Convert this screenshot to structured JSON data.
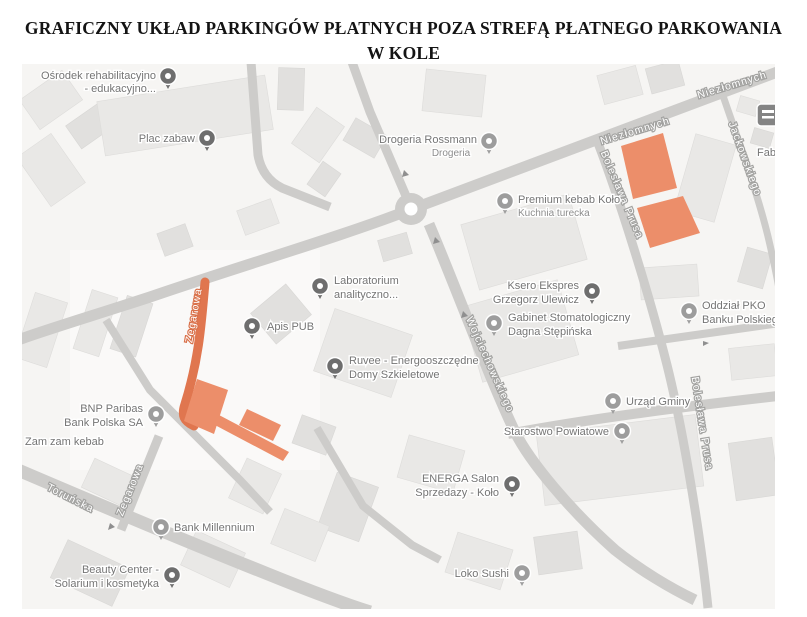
{
  "title": {
    "line1": "GRAFICZNY UKŁAD PARKINGÓW PŁATNYCH POZA STREFĄ PŁATNEGO PARKOWANIA",
    "line2": "W KOLE"
  },
  "map": {
    "colors": {
      "background": "#f6f5f3",
      "building": "#e9e8e6",
      "building_dark": "#e1e0de",
      "road": "#cdccca",
      "road_highlight": "#e0764f",
      "parking": "#ec8e6a",
      "pin_dark": "#6e6e6e",
      "pin_light": "#9d9d9d",
      "poi_text": "#757575",
      "street_halo": "#a2a2a0",
      "street_halo_orange": "#d9714a",
      "title_text": "#141414"
    },
    "pois": [
      {
        "line1": "Ośrodek rehabilitacyjno",
        "line2": "- edukacyjno...",
        "icon": "school-pin",
        "pin": "dark"
      },
      {
        "line1": "Plac zabaw",
        "line2": "",
        "icon": "playground-pin",
        "pin": "dark"
      },
      {
        "line1": "Drogeria Rossmann",
        "line2": "Drogeria",
        "icon": "store-pin",
        "pin": "light"
      },
      {
        "line1": "Premium kebab Koło",
        "line2": "Kuchnia turecka",
        "icon": "restaurant-pin",
        "pin": "light"
      },
      {
        "line1": "Laboratorium",
        "line2": "analityczno...",
        "icon": "lab-pin",
        "pin": "dark"
      },
      {
        "line1": "Apis PUB",
        "line2": "",
        "icon": "bar-pin",
        "pin": "dark"
      },
      {
        "line1": "Ksero Ekspres",
        "line2": "Grzegorz Ulewicz",
        "icon": "print-pin",
        "pin": "dark"
      },
      {
        "line1": "Gabinet Stomatologiczny",
        "line2": "Dagna Stępińska",
        "icon": "dentist-pin",
        "pin": "light"
      },
      {
        "line1": "Oddział PKO",
        "line2": "Banku Polskiego",
        "icon": "bank-pin",
        "pin": "light"
      },
      {
        "line1": "Ruvee - Energooszczędne",
        "line2": "Domy Szkieletowe",
        "icon": "home-pin",
        "pin": "dark"
      },
      {
        "line1": "Urząd Gminy",
        "line2": "",
        "icon": "government-pin",
        "pin": "light"
      },
      {
        "line1": "Starostwo Powiatowe",
        "line2": "",
        "icon": "government-pin",
        "pin": "light"
      },
      {
        "line1": "BNP Paribas",
        "line2": "Bank Polska SA",
        "icon": "bank-pin",
        "pin": "light"
      },
      {
        "line1": "Zam zam kebab",
        "line2": "",
        "icon": "none",
        "pin": "none"
      },
      {
        "line1": "ENERGA Salon",
        "line2": "Sprzedazy - Koło",
        "icon": "energy-pin",
        "pin": "dark"
      },
      {
        "line1": "Bank Millennium",
        "line2": "",
        "icon": "bank-pin",
        "pin": "light"
      },
      {
        "line1": "Beauty Center -",
        "line2": "Solarium i kosmetyka",
        "icon": "beauty-pin",
        "pin": "dark"
      },
      {
        "line1": "Loko Sushi",
        "line2": "",
        "icon": "restaurant-pin",
        "pin": "light"
      }
    ],
    "streets": [
      {
        "name": "Niezłomnych"
      },
      {
        "name": "Niezłomnych"
      },
      {
        "name": "Bolesława Prusa"
      },
      {
        "name": "Bolesława Prusa"
      },
      {
        "name": "Jackowskiego"
      },
      {
        "name": "Wojciechowskiego"
      },
      {
        "name": "Zegarowa",
        "highlighted": true
      },
      {
        "name": "Zegarowa"
      },
      {
        "name": "Toruńska"
      }
    ],
    "edge_labels": [
      {
        "text": "Fabr"
      }
    ],
    "highlighted_road": {
      "name": "Zegarowa",
      "path": "M 205,282 C 201,330 198,362 185,404 C 181,416 184,421 194,426"
    },
    "parking_areas": [
      {
        "points": "621,146 663,133 677,188 633,199"
      },
      {
        "points": "637,208 683,196 700,233 650,248"
      },
      {
        "points": "197,379 228,390 214,434 184,421"
      },
      {
        "points": "219,415 289,452 283,461 213,424"
      },
      {
        "points": "247,409 281,425 273,441 239,425"
      }
    ]
  }
}
